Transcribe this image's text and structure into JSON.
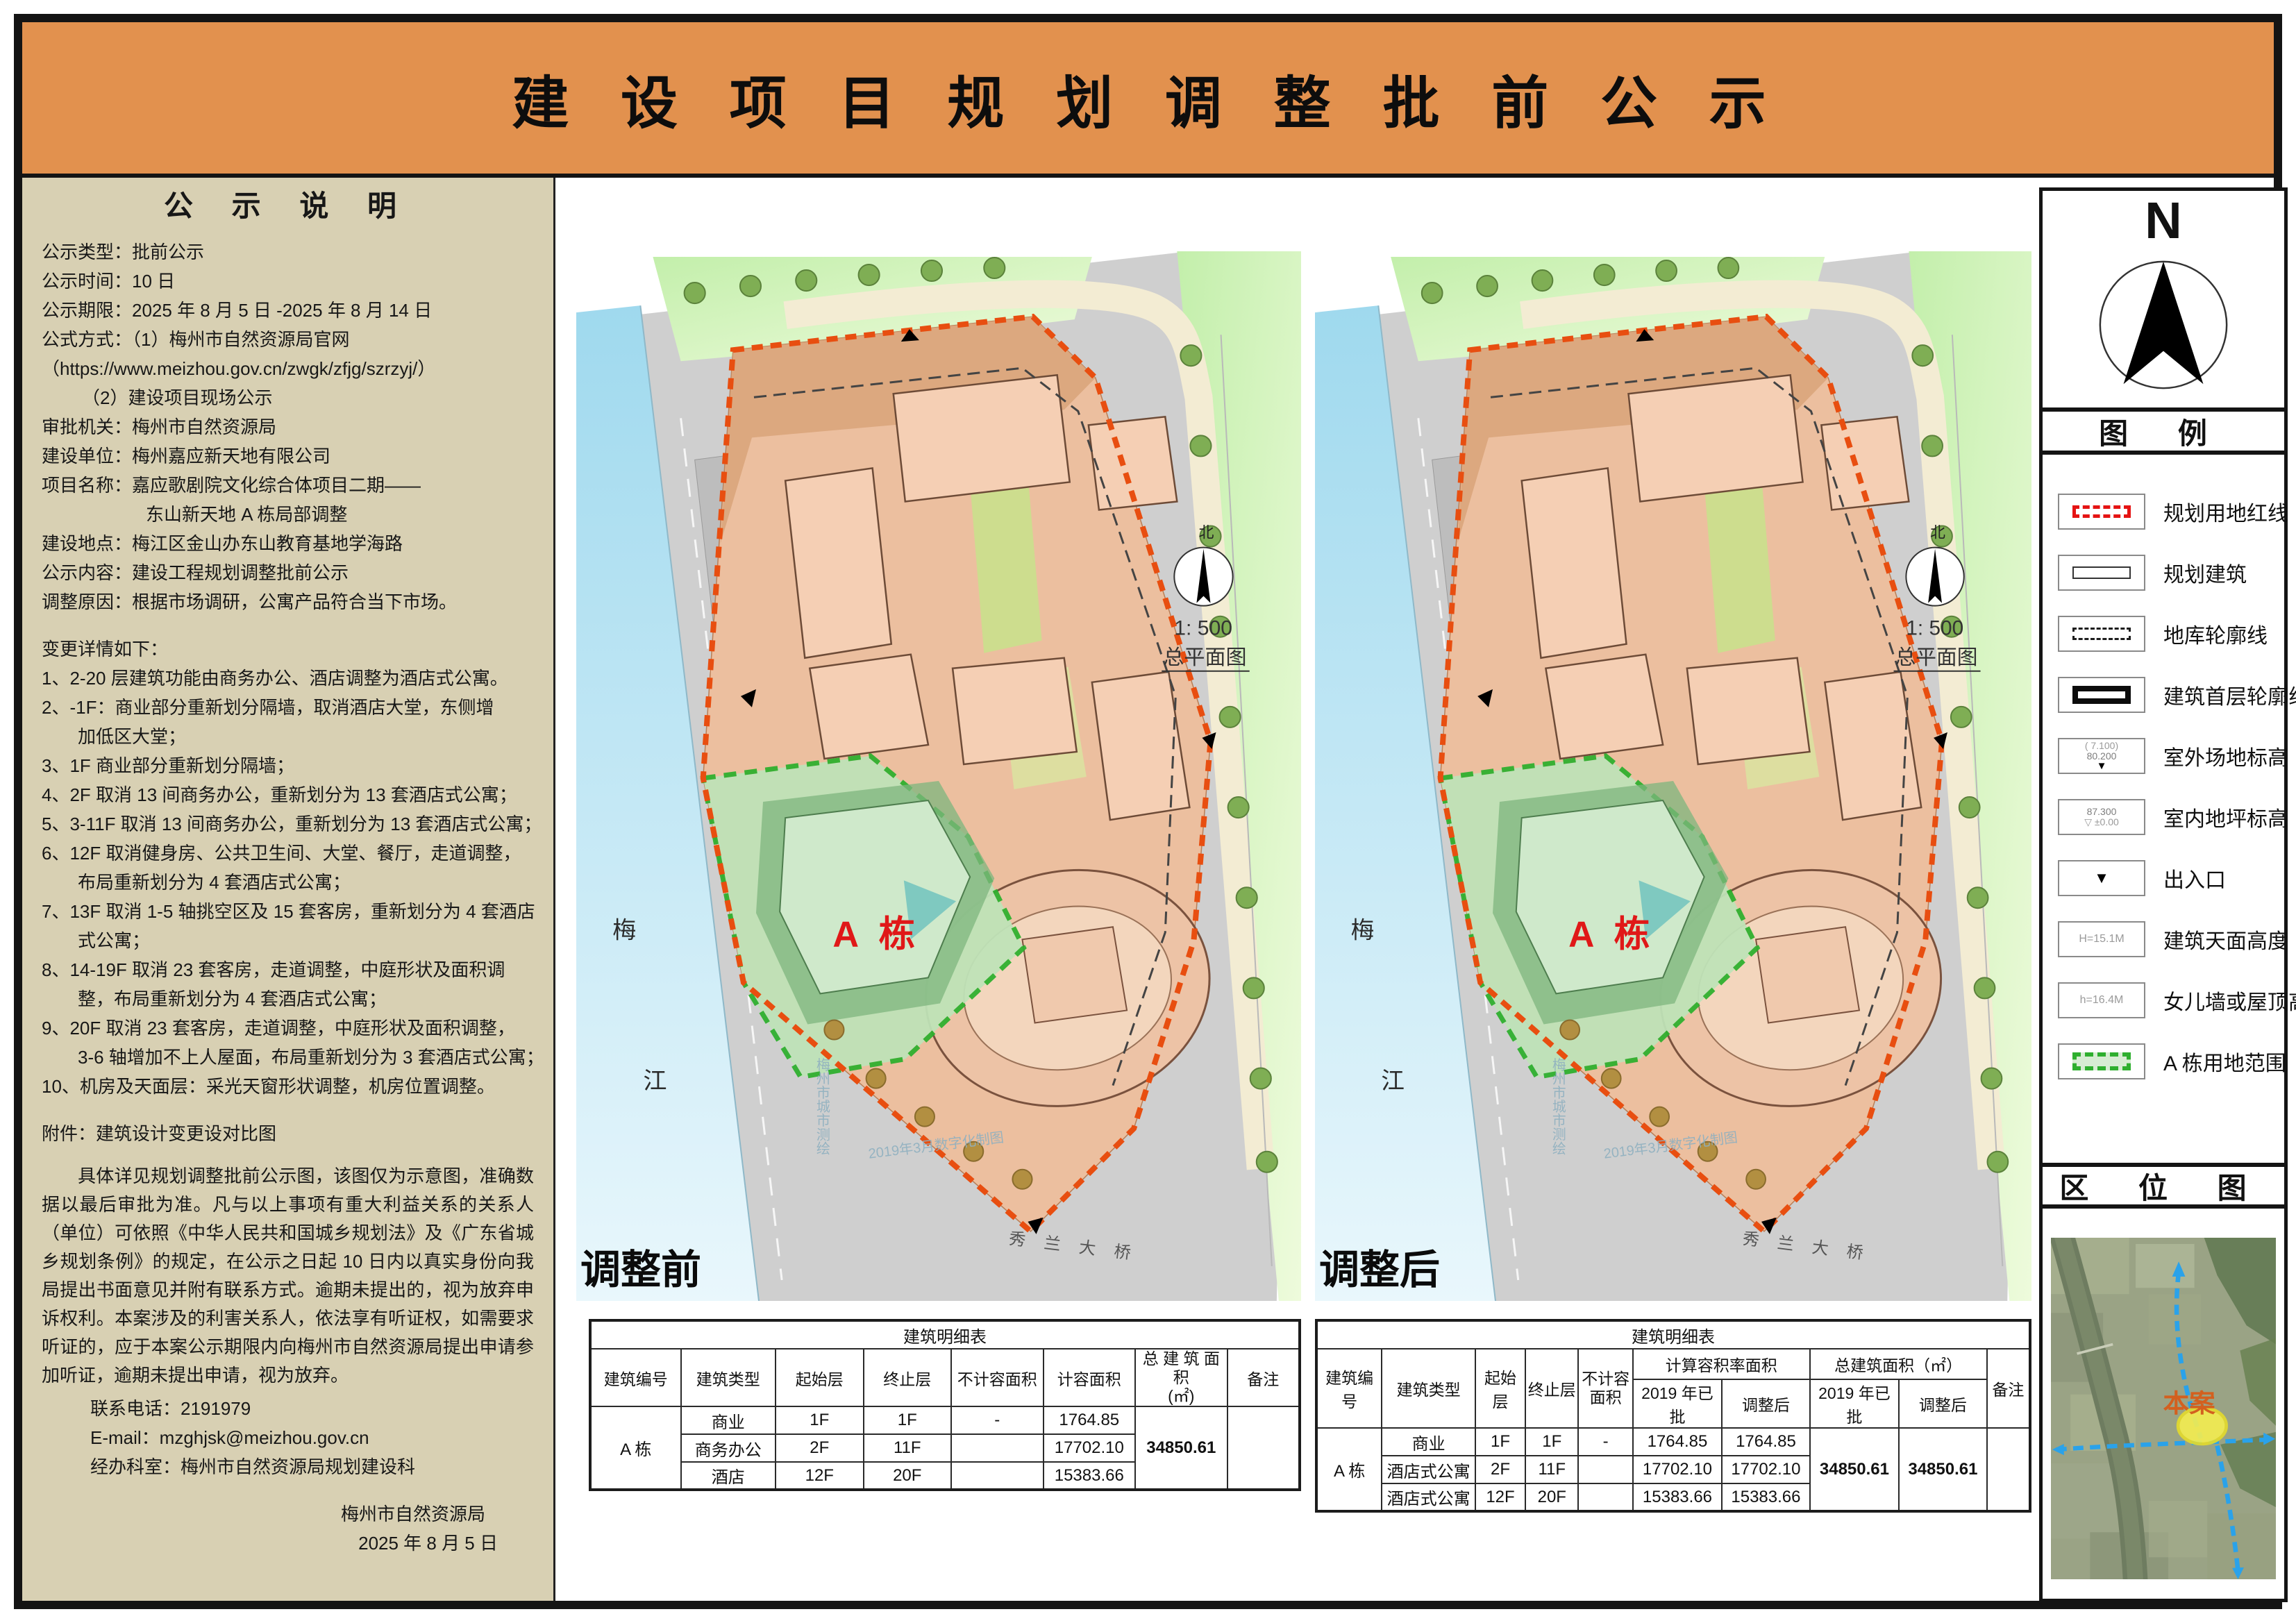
{
  "header": {
    "title": "建 设 项 目 规 划 调 整 批 前 公 示"
  },
  "sidebar": {
    "title": "公 示 说 明",
    "info": [
      "公示类型：批前公示",
      "公示时间：10 日",
      "公示期限：2025 年 8 月 5 日 -2025 年 8 月 14 日",
      "公式方式：（1）梅州市自然资源局官网",
      "（https://www.meizhou.gov.cn/zwgk/zfjg/szrzyj/）",
      "（2）建设项目现场公示",
      "审批机关：梅州市自然资源局",
      "建设单位：梅州嘉应新天地有限公司",
      "项目名称：嘉应歌剧院文化综合体项目二期——",
      "东山新天地 A 栋局部调整",
      "建设地点：梅江区金山办东山教育基地学海路",
      "公示内容：建设工程规划调整批前公示",
      "调整原因：根据市场调研，公寓产品符合当下市场。"
    ],
    "changes_title": "变更详情如下：",
    "changes": [
      "1、2-20 层建筑功能由商务办公、酒店调整为酒店式公寓。",
      "2、-1F：商业部分重新划分隔墙，取消酒店大堂，东侧增",
      "加低区大堂；",
      "3、1F 商业部分重新划分隔墙；",
      "4、2F 取消 13 间商务办公，重新划分为 13 套酒店式公寓；",
      "5、3-11F 取消 13 间商务办公，重新划分为 13 套酒店式公寓；",
      "6、12F 取消健身房、公共卫生间、大堂、餐厅，走道调整，",
      "布局重新划分为 4 套酒店式公寓；",
      "7、13F 取消 1-5 轴挑空区及 15 套客房，重新划分为 4 套酒店",
      "式公寓；",
      "8、14-19F 取消 23 套客房，走道调整，中庭形状及面积调",
      "整，布局重新划分为 4 套酒店式公寓；",
      "9、20F 取消 23 套客房，走道调整，中庭形状及面积调整，",
      "3-6 轴增加不上人屋面，布局重新划分为 3 套酒店式公寓；",
      "10、机房及天面层：采光天窗形状调整，机房位置调整。"
    ],
    "attachment": "附件：建筑设计变更设对比图",
    "legal": "具体详见规划调整批前公示图，该图仅为示意图，准确数据以最后审批为准。凡与以上事项有重大利益关系的关系人（单位）可依照《中华人民共和国城乡规划法》及《广东省城乡规划条例》的规定，在公示之日起 10 日内以真实身份向我局提出书面意见并附有联系方式。逾期未提出的，视为放弃申诉权利。本案涉及的利害关系人，依法享有听证权，如需要求听证的，应于本案公示期限内向梅州市自然资源局提出申请参加听证，逾期未提出申请，视为放弃。",
    "phone": "联系电话：2191979",
    "email": "E-mail：mzghjsk@meizhou.gov.cn",
    "office": "经办科室：梅州市自然资源局规划建设科",
    "signer": "梅州市自然资源局",
    "sign_date": "2025 年 8 月 5 日"
  },
  "map": {
    "before_label": "调整前",
    "after_label": "调整后",
    "a_block": "A 栋",
    "river_top": "梅",
    "river_bottom": "江",
    "bridge": "秀 兰 大 桥",
    "north": "北",
    "scale": "1: 500",
    "plan": "总平面图",
    "watermark1": "梅州市城市测绘",
    "watermark2": "2019年3月数字化制图"
  },
  "tables": {
    "before": {
      "title": "建筑明细表",
      "headers": [
        "建筑编号",
        "建筑类型",
        "起始层",
        "终止层",
        "不计容面积",
        "计容面积",
        "总 建 筑 面 积\n(㎡)",
        "备注"
      ],
      "building_id": "A 栋",
      "rows": [
        [
          "商业",
          "1F",
          "1F",
          "-",
          "1764.85"
        ],
        [
          "商务办公",
          "2F",
          "11F",
          "",
          "17702.10"
        ],
        [
          "酒店",
          "12F",
          "20F",
          "",
          "15383.66"
        ]
      ],
      "total": "34850.61",
      "remark": ""
    },
    "after": {
      "title": "建筑明细表",
      "h_id": "建筑编号",
      "h_type": "建筑类型",
      "h_start": "起始层",
      "h_end": "终止层",
      "h_nofar": "不计容\n面积",
      "h_far_group": "计算容积率面积",
      "h_total_group": "总建筑面积（㎡）",
      "sub_headers": [
        "2019 年已批",
        "调整后",
        "2019 年已批",
        "调整后"
      ],
      "h_remark": "备注",
      "building_id": "A 栋",
      "rows": [
        [
          "商业",
          "1F",
          "1F",
          "-",
          "1764.85",
          "1764.85"
        ],
        [
          "酒店式公寓",
          "2F",
          "11F",
          "",
          "17702.10",
          "17702.10"
        ],
        [
          "酒店式公寓",
          "12F",
          "20F",
          "",
          "15383.66",
          "15383.66"
        ]
      ],
      "total_2019": "34850.61",
      "total_after": "34850.61",
      "remark": ""
    }
  },
  "panel": {
    "north_letter": "N",
    "legend_title": "图  例",
    "legend": [
      {
        "label": "规划用地红线"
      },
      {
        "label": "规划建筑"
      },
      {
        "label": "地库轮廓线"
      },
      {
        "label": "建筑首层轮廓线"
      },
      {
        "label": "室外场地标高",
        "t1": "( 7.100)",
        "t2": "80.200"
      },
      {
        "label": "室内地坪标高",
        "t1": "87.300",
        "t2": "±0.00"
      },
      {
        "label": "出入口"
      },
      {
        "label": "建筑天面高度",
        "t1": "H=15.1M"
      },
      {
        "label": "女儿墙或屋顶高度",
        "t1": "h=16.4M"
      },
      {
        "label": "A 栋用地范围"
      }
    ],
    "location_title": "区  位  图",
    "site_label": "本案"
  },
  "colors": {
    "header_orange": "#E2914E",
    "sidebar_beige": "#D8D0B3",
    "red_boundary": "#E84E10",
    "green_zone": "#2EB02E",
    "a_label_red": "#E01818",
    "water_blue": "#AEDFF2",
    "site_salmon": "#ECBF9F"
  }
}
